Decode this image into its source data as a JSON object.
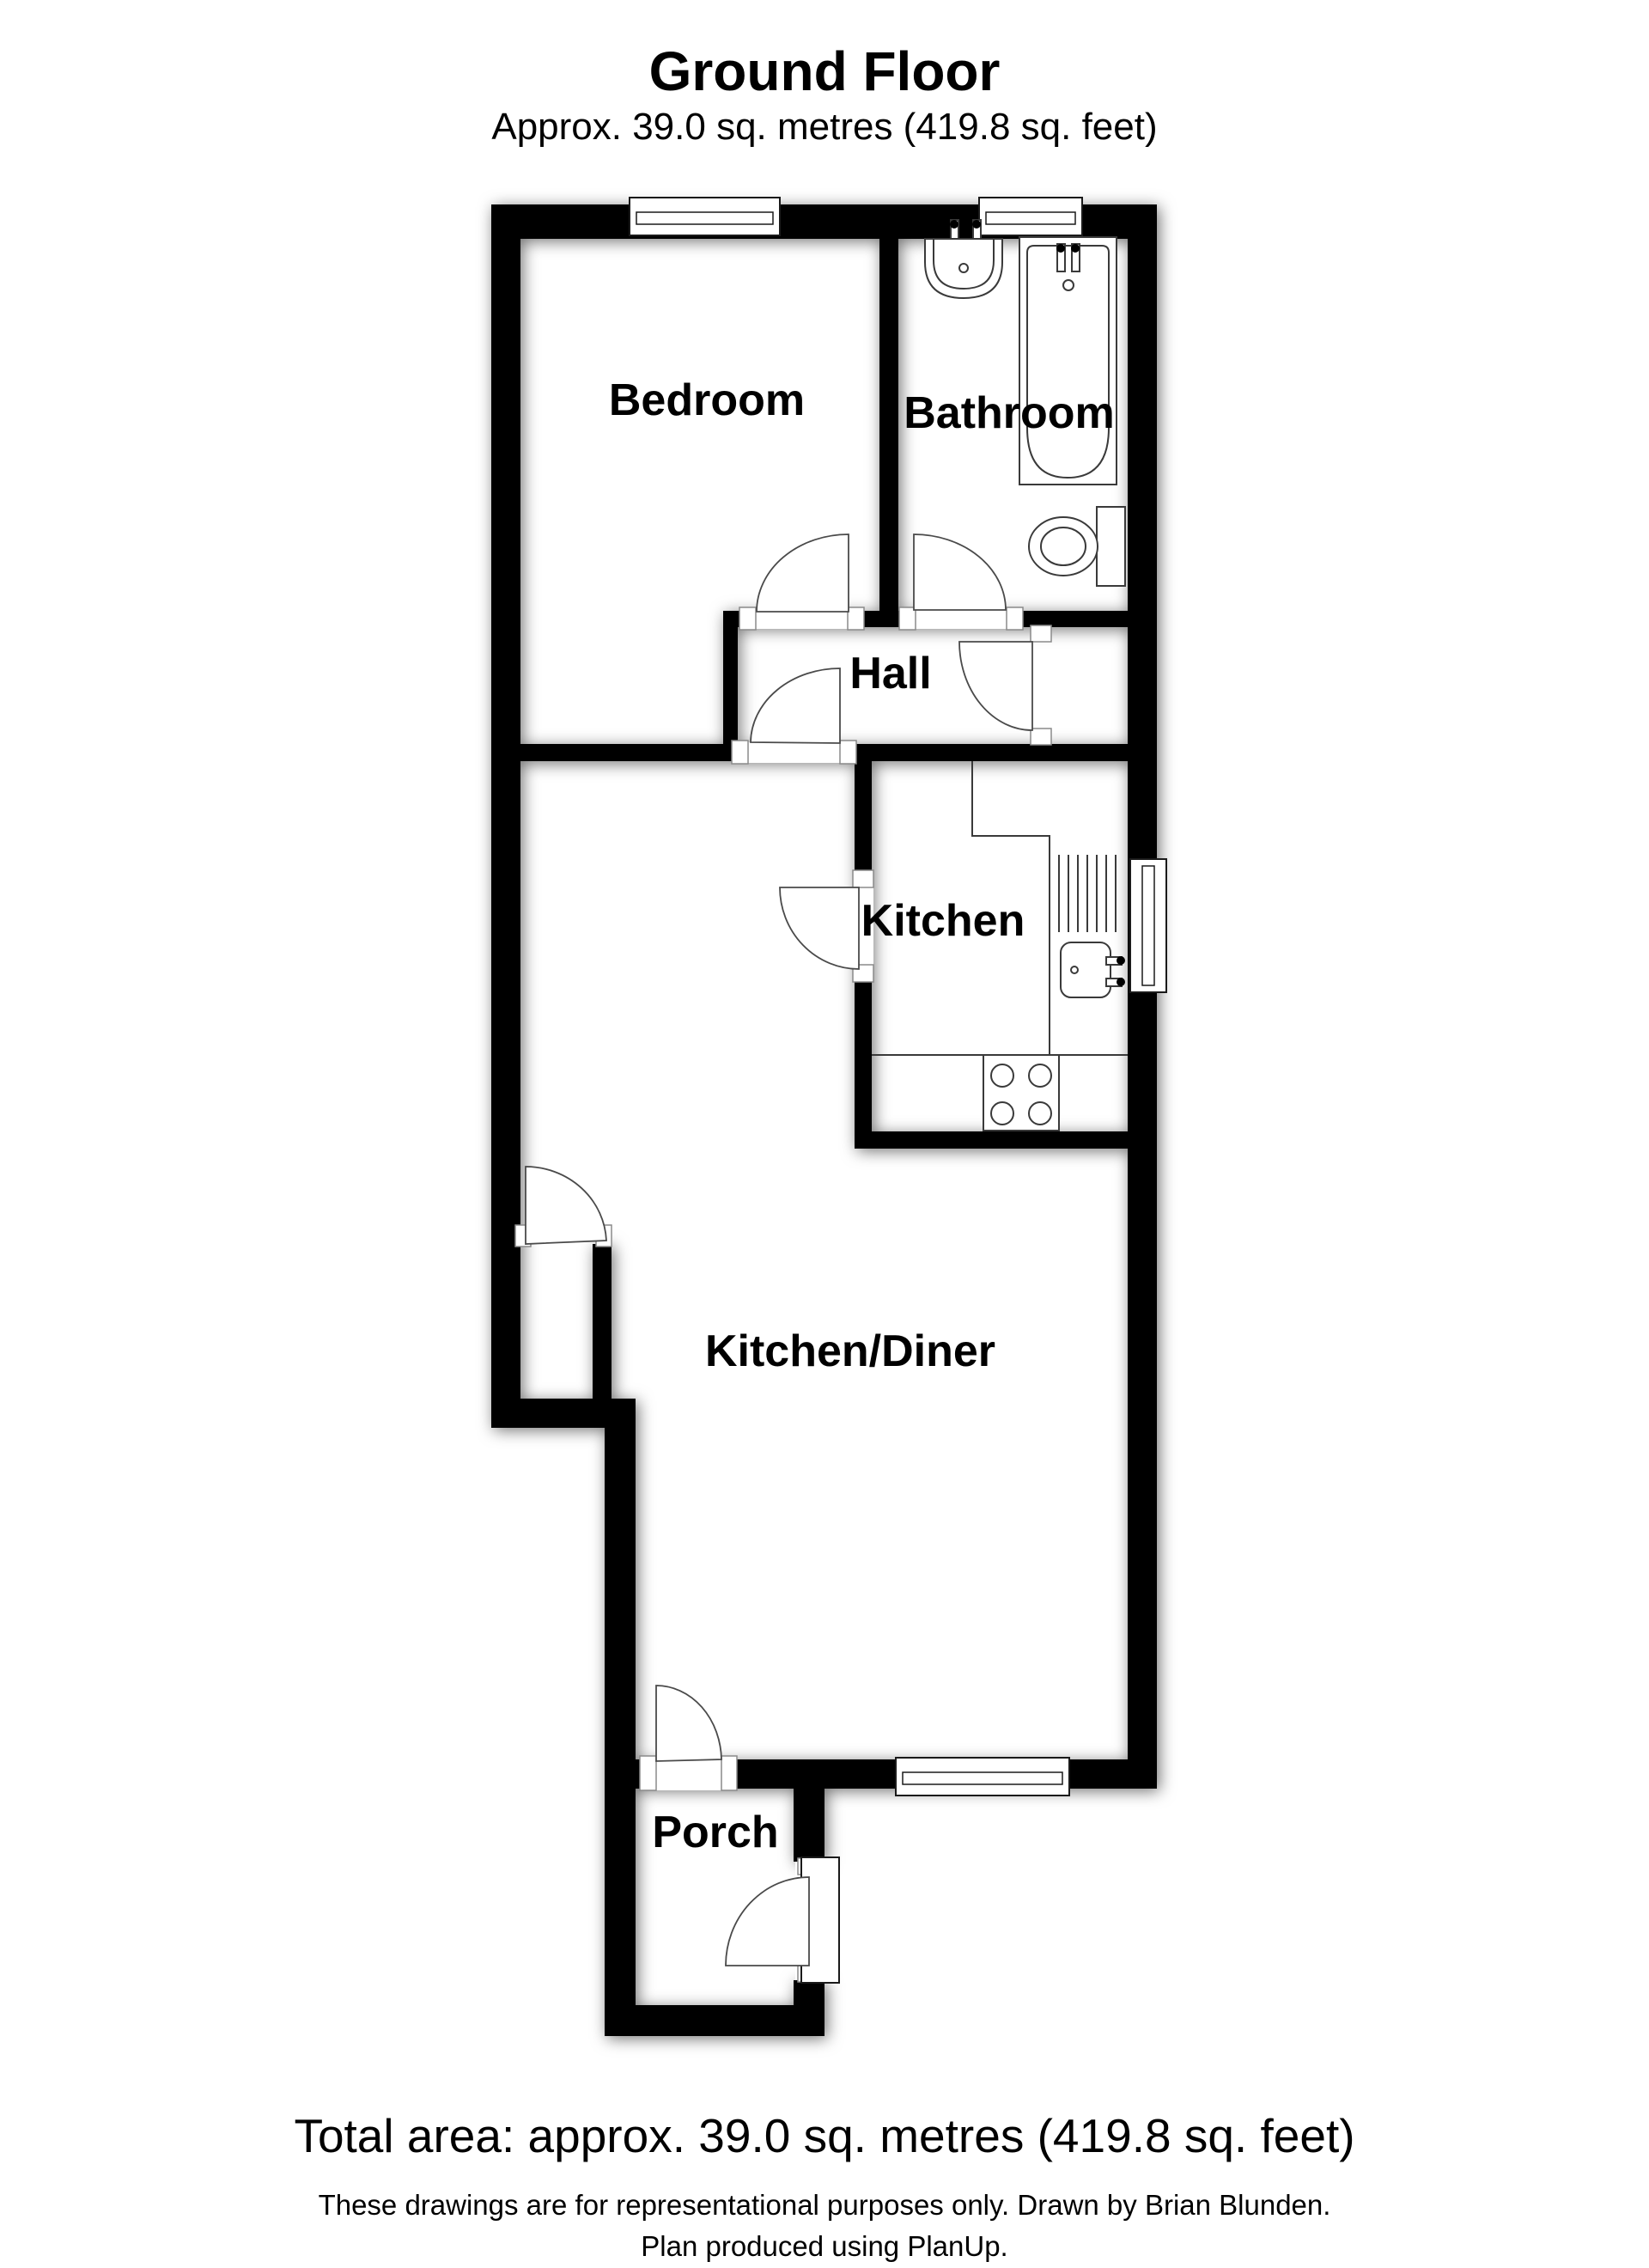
{
  "title": "Ground Floor",
  "subtitle": "Approx. 39.0 sq. metres (419.8 sq. feet)",
  "rooms": {
    "bedroom": "Bedroom",
    "bathroom": "Bathroom",
    "hall": "Hall",
    "kitchen": "Kitchen",
    "kitchen_diner": "Kitchen/Diner",
    "porch": "Porch"
  },
  "footer": {
    "total_area": "Total area: approx. 39.0 sq. metres (419.8 sq. feet)",
    "disclaimer": "These drawings are for representational purposes only. Drawn by Brian Blunden.",
    "produced": "Plan produced using PlanUp."
  },
  "colors": {
    "wall": "#000000",
    "background": "#ffffff",
    "line": "#3a3a3a"
  }
}
